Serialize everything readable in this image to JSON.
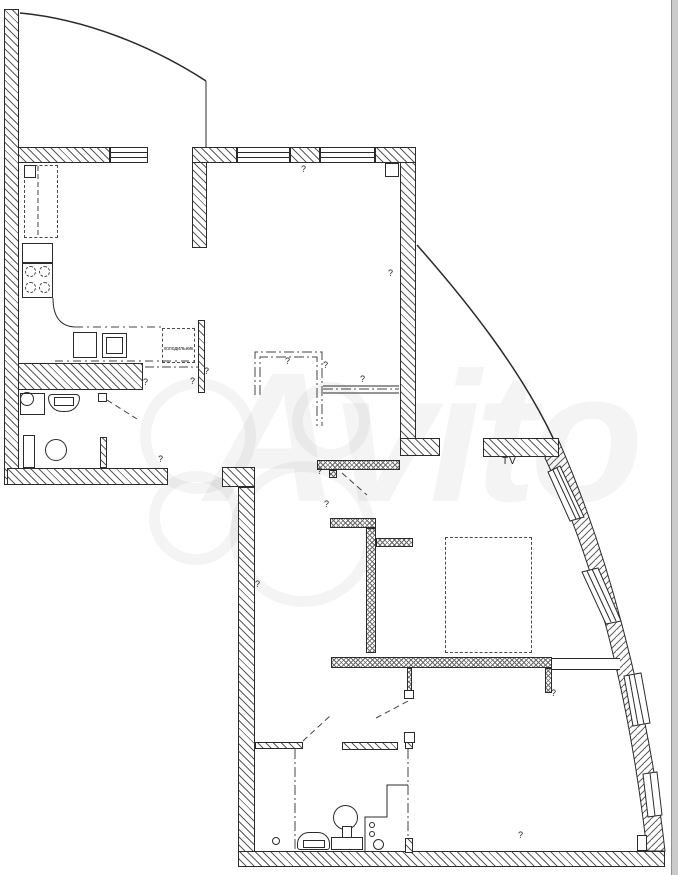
{
  "title": "apartment-floor-plan",
  "watermark": {
    "text": "Avito"
  },
  "labels": {
    "fridge": "холодильник",
    "tv": "TV",
    "question_mark": "?"
  },
  "colors": {
    "line": "#2b2b2b",
    "background": "#ffffff",
    "watermark": "rgba(0,0,0,0.042)",
    "scrollbar_track": "#cbcbcb",
    "scrollbar_edge": "#8f8f8f"
  }
}
